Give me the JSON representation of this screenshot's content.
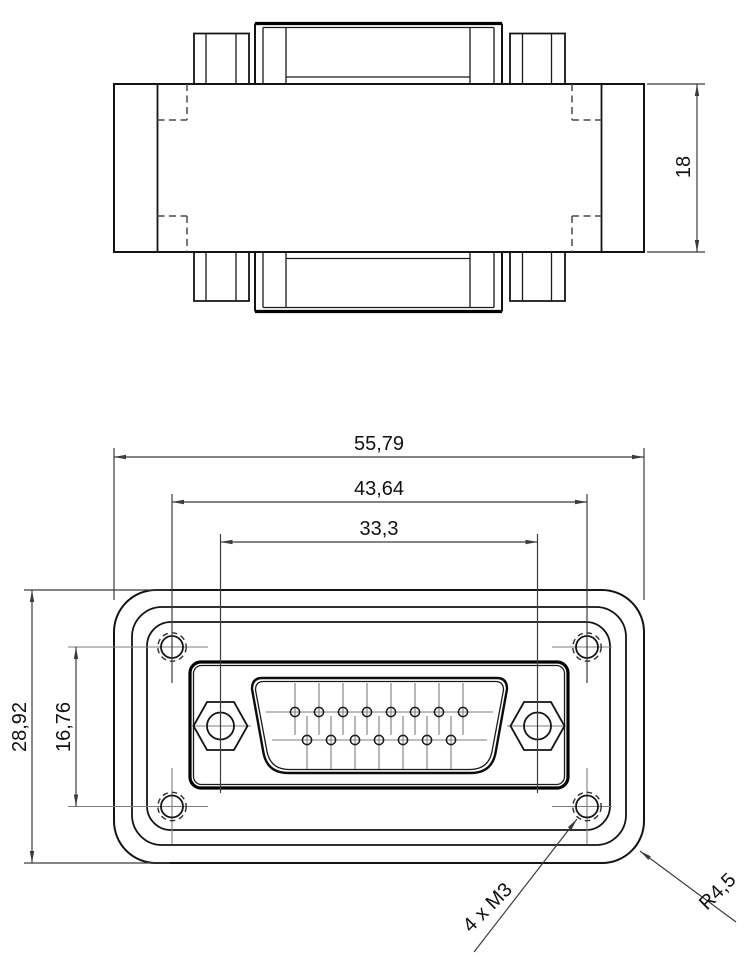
{
  "drawing": {
    "colors": {
      "background": "#ffffff",
      "geometry_line": "#141414",
      "centerline": "#7d7d7d",
      "dimension_line": "#3c3c3c",
      "text": "#111111"
    },
    "dimensions": {
      "body_height": "18",
      "overall_width": "55,79",
      "mount_hole_spacing_horizontal": "43,64",
      "jackscrew_spacing": "33,3",
      "overall_height": "28,92",
      "mount_hole_spacing_vertical": "16,76",
      "mount_hole_thread": "4 x M3",
      "corner_radius": "R4,5"
    },
    "front_view": {
      "mount_hole_count": 4,
      "pins": {
        "radius": 4.6,
        "top_row": {
          "count": 8,
          "y": 712,
          "cl_y1": 683,
          "cl_y2": 735,
          "xs": [
            295,
            319,
            343,
            367,
            391,
            415,
            439,
            463
          ]
        },
        "bottom_row": {
          "count": 7,
          "y": 740,
          "cl_y1": 716,
          "cl_y2": 769,
          "xs": [
            307,
            331,
            355,
            379,
            403,
            427,
            451
          ]
        }
      }
    }
  }
}
